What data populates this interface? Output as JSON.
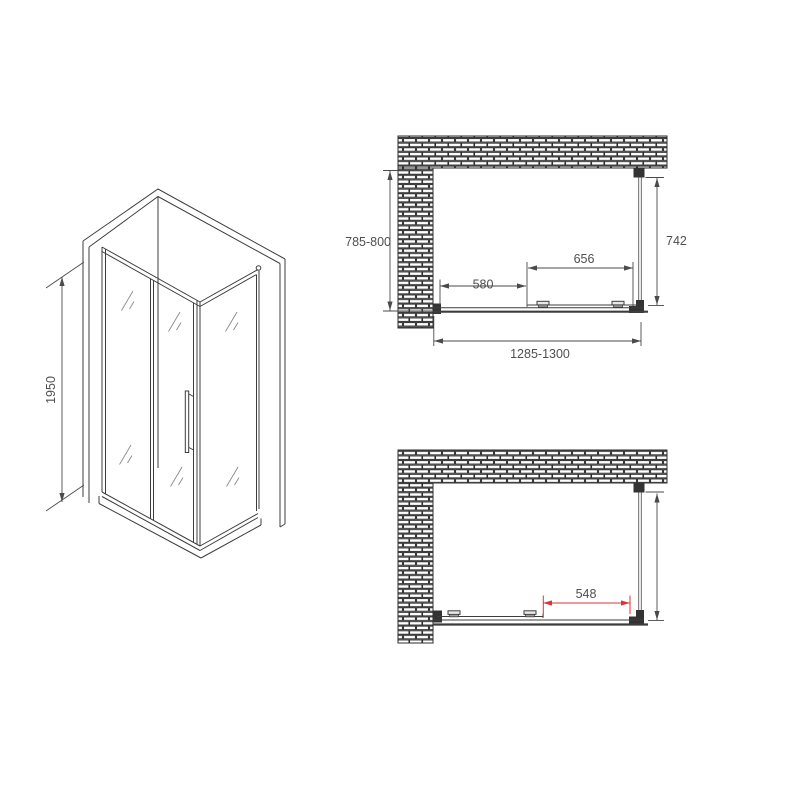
{
  "title": "Shower enclosure technical drawing",
  "iso_view": {
    "height_dim": "1950"
  },
  "plan_closed": {
    "depth_dim": "785-800",
    "side_dim": "742",
    "door_dim": "656",
    "clear_dim": "580",
    "width_dim": "1285-1300"
  },
  "plan_open": {
    "opening_dim": "548"
  },
  "colors": {
    "line": "#3d3d3d",
    "dim_text": "#4f4f4f",
    "accent_red": "#d9363a",
    "background": "#ffffff"
  }
}
